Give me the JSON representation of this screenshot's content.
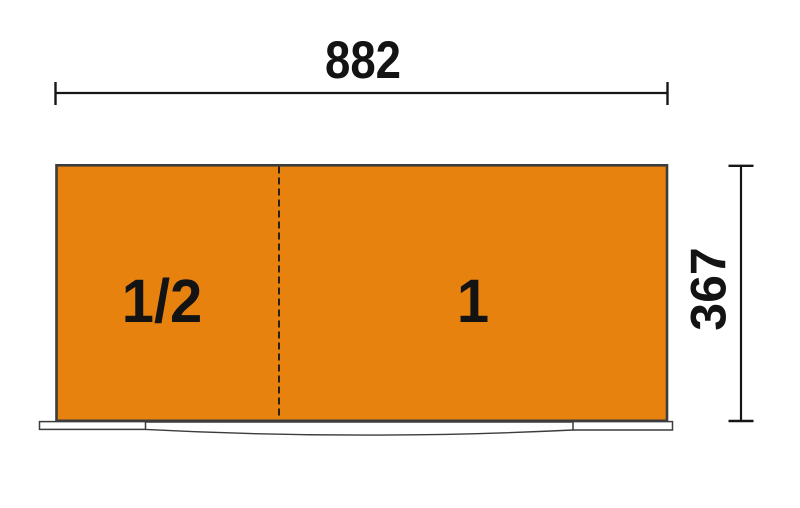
{
  "drawing": {
    "dimensions": {
      "width": "882",
      "height": "367"
    },
    "modules": {
      "left": "1/2",
      "right": "1"
    },
    "colors": {
      "module_fill": "#E8820F",
      "outline": "#3C3C3C",
      "dimension": "#161616",
      "background": "#FFFFFF"
    }
  }
}
